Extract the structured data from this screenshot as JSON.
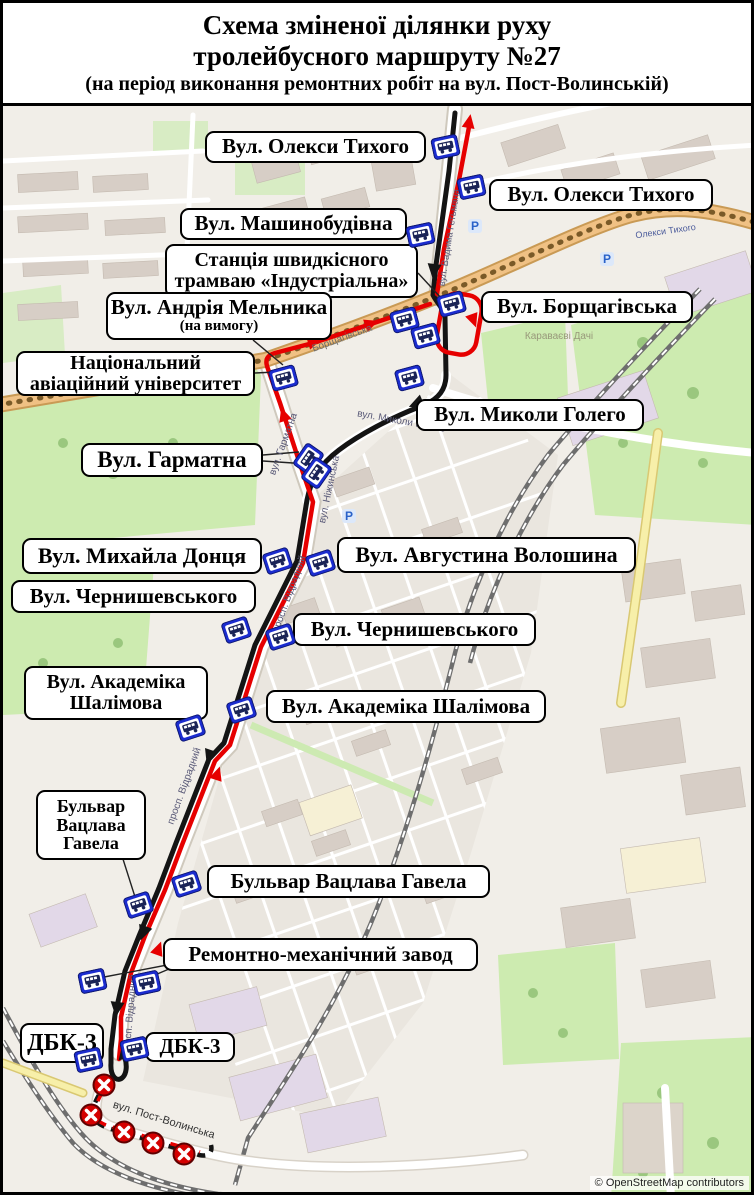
{
  "title": {
    "line1": "Схема зміненої ділянки руху",
    "line2": "тролейбусного маршруту №27",
    "subtitle": "(на період виконання ремонтних робіт на вул. Пост-Волинській)"
  },
  "attribution": "© OpenStreetMap contributors",
  "colors": {
    "route_red": "#e60000",
    "route_black": "#141414",
    "stop_blue": "#1b2ccf",
    "closed_red": "#d40000",
    "label_bg": "#ffffff",
    "label_border": "#000000",
    "park_green": "#cdebb0",
    "avenue_tan": "#f0c184",
    "map_bg": "#f1eee8"
  },
  "labels": [
    {
      "id": "oleksy-tykhoho-left",
      "x": 202,
      "y": 128,
      "w": 221,
      "h": 32,
      "lines": [
        {
          "t": "Вул. Олекси Тихого",
          "fs": 21
        }
      ]
    },
    {
      "id": "oleksy-tykhoho-right",
      "x": 486,
      "y": 176,
      "w": 224,
      "h": 32,
      "lines": [
        {
          "t": "Вул. Олекси Тихого",
          "fs": 21
        }
      ]
    },
    {
      "id": "mashynobudivna",
      "x": 177,
      "y": 205,
      "w": 227,
      "h": 32,
      "lines": [
        {
          "t": "Вул. Машинобудівна",
          "fs": 21
        }
      ]
    },
    {
      "id": "stantsiya-industrialna",
      "x": 162,
      "y": 241,
      "w": 253,
      "h": 54,
      "lines": [
        {
          "t": "Станція швидкісного",
          "fs": 20
        },
        {
          "t": "трамваю «Індустріальна»",
          "fs": 20
        }
      ]
    },
    {
      "id": "andriya-melnyka",
      "x": 103,
      "y": 289,
      "w": 226,
      "h": 48,
      "lines": [
        {
          "t": "Вул. Андрія Мельника",
          "fs": 21
        },
        {
          "t": "(на вимогу)",
          "fs": 15
        }
      ]
    },
    {
      "id": "borshchahivska",
      "x": 478,
      "y": 288,
      "w": 212,
      "h": 32,
      "lines": [
        {
          "t": "Вул. Борщагівська",
          "fs": 21
        }
      ]
    },
    {
      "id": "nau",
      "x": 13,
      "y": 348,
      "w": 239,
      "h": 45,
      "lines": [
        {
          "t": "Національний",
          "fs": 20
        },
        {
          "t": "авіаційний університет",
          "fs": 20
        }
      ]
    },
    {
      "id": "mykoly-holeho",
      "x": 413,
      "y": 396,
      "w": 228,
      "h": 32,
      "lines": [
        {
          "t": "Вул. Миколи Голего",
          "fs": 21
        }
      ]
    },
    {
      "id": "harmatna",
      "x": 78,
      "y": 440,
      "w": 182,
      "h": 34,
      "lines": [
        {
          "t": "Вул. Гарматна",
          "fs": 23
        }
      ]
    },
    {
      "id": "mykhayla-dontsya",
      "x": 19,
      "y": 535,
      "w": 240,
      "h": 36,
      "lines": [
        {
          "t": "Вул. Михайла Донця",
          "fs": 22
        }
      ]
    },
    {
      "id": "avhustyna-voloshyna",
      "x": 334,
      "y": 534,
      "w": 299,
      "h": 36,
      "lines": [
        {
          "t": "Вул. Августина Волошина",
          "fs": 22
        }
      ]
    },
    {
      "id": "chernyshevskoho-left",
      "x": 8,
      "y": 577,
      "w": 245,
      "h": 33,
      "lines": [
        {
          "t": "Вул. Чернишевського",
          "fs": 21
        }
      ]
    },
    {
      "id": "chernyshevskoho-right",
      "x": 290,
      "y": 610,
      "w": 243,
      "h": 33,
      "lines": [
        {
          "t": "Вул. Чернишевського",
          "fs": 21
        }
      ]
    },
    {
      "id": "akademika-shalimova-left",
      "x": 21,
      "y": 663,
      "w": 184,
      "h": 54,
      "lines": [
        {
          "t": "Вул. Академіка",
          "fs": 20
        },
        {
          "t": "Шалімова",
          "fs": 20
        }
      ]
    },
    {
      "id": "akademika-shalimova-right",
      "x": 263,
      "y": 687,
      "w": 280,
      "h": 33,
      "lines": [
        {
          "t": "Вул. Академіка Шалімова",
          "fs": 21
        }
      ]
    },
    {
      "id": "vatslava-havela-left",
      "x": 33,
      "y": 787,
      "w": 110,
      "h": 70,
      "lines": [
        {
          "t": "Бульвар",
          "fs": 18
        },
        {
          "t": "Вацлава",
          "fs": 18
        },
        {
          "t": "Гавела",
          "fs": 18
        }
      ]
    },
    {
      "id": "vatslava-havela-right",
      "x": 204,
      "y": 862,
      "w": 283,
      "h": 33,
      "lines": [
        {
          "t": "Бульвар Вацлава Гавела",
          "fs": 21
        }
      ]
    },
    {
      "id": "remontno-mekhanichnyi",
      "x": 160,
      "y": 935,
      "w": 315,
      "h": 33,
      "lines": [
        {
          "t": "Ремонтно-механічний завод",
          "fs": 21
        }
      ]
    },
    {
      "id": "dbk3-left",
      "x": 17,
      "y": 1020,
      "w": 84,
      "h": 40,
      "lines": [
        {
          "t": "ДБК-3",
          "fs": 24
        }
      ]
    },
    {
      "id": "dbk3-right",
      "x": 142,
      "y": 1029,
      "w": 90,
      "h": 30,
      "lines": [
        {
          "t": "ДБК-3",
          "fs": 21
        }
      ]
    }
  ],
  "stops": [
    {
      "x": 442,
      "y": 144,
      "r": -12
    },
    {
      "x": 468,
      "y": 184,
      "r": -12
    },
    {
      "x": 417,
      "y": 232,
      "r": -12
    },
    {
      "x": 448,
      "y": 301,
      "r": -15
    },
    {
      "x": 401,
      "y": 317,
      "r": -15
    },
    {
      "x": 422,
      "y": 333,
      "r": -15
    },
    {
      "x": 406,
      "y": 375,
      "r": -15
    },
    {
      "x": 280,
      "y": 375,
      "r": -15
    },
    {
      "x": 305,
      "y": 456,
      "r": -55
    },
    {
      "x": 313,
      "y": 470,
      "r": -55
    },
    {
      "x": 274,
      "y": 558,
      "r": -18
    },
    {
      "x": 317,
      "y": 560,
      "r": -18
    },
    {
      "x": 233,
      "y": 627,
      "r": -18
    },
    {
      "x": 277,
      "y": 634,
      "r": -18
    },
    {
      "x": 187,
      "y": 725,
      "r": -18
    },
    {
      "x": 238,
      "y": 707,
      "r": -18
    },
    {
      "x": 135,
      "y": 902,
      "r": -18
    },
    {
      "x": 183,
      "y": 881,
      "r": -18
    },
    {
      "x": 89,
      "y": 978,
      "r": -12
    },
    {
      "x": 143,
      "y": 980,
      "r": -12
    },
    {
      "x": 85,
      "y": 1057,
      "r": -12
    },
    {
      "x": 131,
      "y": 1046,
      "r": -12
    }
  ],
  "closed_stops": [
    {
      "x": 101,
      "y": 1082
    },
    {
      "x": 88,
      "y": 1112
    },
    {
      "x": 121,
      "y": 1129
    },
    {
      "x": 150,
      "y": 1140
    },
    {
      "x": 181,
      "y": 1151
    }
  ],
  "street_names": [
    {
      "t": "вул. Вадима Гетьмана",
      "x": 449,
      "y": 235,
      "r": -81,
      "fs": 9.5,
      "c": "#5a5a78"
    },
    {
      "t": "Борщагівська",
      "x": 340,
      "y": 338,
      "r": -20,
      "fs": 10,
      "c": "#6b6b6b"
    },
    {
      "t": "вул. Гарматна",
      "x": 283,
      "y": 442,
      "r": -70,
      "fs": 10,
      "c": "#5a5a78"
    },
    {
      "t": "вул. Ніжинська",
      "x": 329,
      "y": 487,
      "r": -78,
      "fs": 10,
      "c": "#5a5a78"
    },
    {
      "t": "вул. Миколи Голего",
      "x": 398,
      "y": 421,
      "r": 10,
      "fs": 10,
      "c": "#5a5a78"
    },
    {
      "t": "просп. Відрадний",
      "x": 289,
      "y": 592,
      "r": -70,
      "fs": 10,
      "c": "#5a5a78"
    },
    {
      "t": "просп. Відрадний",
      "x": 184,
      "y": 784,
      "r": -70,
      "fs": 10,
      "c": "#5a5a78"
    },
    {
      "t": "просп. Відрадний",
      "x": 130,
      "y": 1012,
      "r": -85,
      "fs": 10,
      "c": "#5a5a78"
    },
    {
      "t": "вул. Пост-Волинська",
      "x": 160,
      "y": 1120,
      "r": 17,
      "fs": 11,
      "c": "#333333"
    },
    {
      "t": "Караваєві Дачі",
      "x": 556,
      "y": 336,
      "r": 0,
      "fs": 10,
      "c": "#98987a"
    },
    {
      "t": "Олекси Тихого",
      "x": 663,
      "y": 231,
      "r": -8,
      "fs": 9,
      "c": "#4a5a9a"
    }
  ],
  "parking_markers": [
    {
      "x": 604,
      "y": 256
    },
    {
      "x": 346,
      "y": 513
    },
    {
      "x": 472,
      "y": 223
    }
  ]
}
